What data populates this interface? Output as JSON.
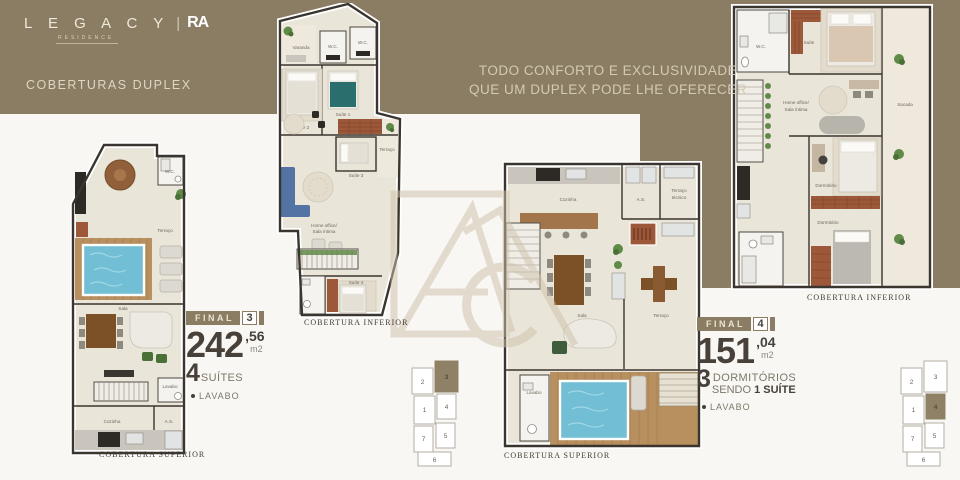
{
  "colors": {
    "brand_gold": "#8a7d64",
    "cream_text": "#ddd5c0",
    "dark_text": "#474139",
    "muted_text": "#7d7769",
    "pool_blue": "#72bfd5",
    "deck_wood": "#b8905f",
    "caption_text": "#423c32"
  },
  "header": {
    "logo_name": "L E G A C Y",
    "logo_divider": "|",
    "logo_partner": "RA",
    "logo_sub": "RESIDENCE",
    "subtitle": "COBERTURAS DUPLEX",
    "tagline_1": "TODO CONFORTO E EXCLUSIVIDADE",
    "tagline_2": "QUE UM DUPLEX PODE LHE OFERECER"
  },
  "unit3": {
    "badge_label": "FINAL",
    "badge_number": "3",
    "area_int": "242",
    "area_dec": ",56",
    "area_unit": "m2",
    "count": "4",
    "count_label": "SUÍTES",
    "bullet_item": "LAVABO"
  },
  "unit4": {
    "badge_label": "FINAL",
    "badge_number": "4",
    "area_int": "151",
    "area_dec": ",04",
    "area_unit": "m2",
    "count": "3",
    "count_label": "DORMITÓRIOS",
    "sub_prefix": "SENDO ",
    "sub_bold": "1 SUÍTE",
    "bullet_item": "LAVABO"
  },
  "plans": {
    "p1": {
      "caption": "COBERTURA SUPERIOR",
      "rooms": {
        "wc": "W.C.",
        "terraco": "Terraço",
        "sala": "Sala",
        "lavabo": "Lavabo",
        "cozinha": "Cozinha",
        "as": "A.S."
      }
    },
    "p2": {
      "caption": "COBERTURA INFERIOR",
      "rooms": {
        "varanda": "Varanda",
        "wc1": "W.C.",
        "wc2": "W.C.",
        "suite2": "Suíte 2",
        "suite1": "Suíte 1",
        "suite3": "Suíte 3",
        "terraco": "Terraço",
        "home1": "Home office/",
        "home2": "Sala íntima",
        "suite4": "Suíte 4"
      }
    },
    "p3": {
      "caption": "COBERTURA SUPERIOR",
      "rooms": {
        "cozinha": "Cozinha",
        "as": "A.S.",
        "ttec1": "Terraço",
        "ttec2": "técnico",
        "sala": "Sala",
        "terraco": "Terraço",
        "lavabo": "Lavabo"
      }
    },
    "p4": {
      "caption": "COBERTURA INFERIOR",
      "rooms": {
        "wc": "W.C.",
        "suite": "Suíte",
        "home1": "Home office/",
        "home2": "Sala íntima",
        "sacada": "Sacada",
        "dorm1": "Dormitório",
        "dorm2": "Dormitório"
      }
    }
  },
  "keyplans": {
    "left": {
      "highlight": "3",
      "cells": [
        "2",
        "3",
        "1",
        "4",
        "7",
        "5",
        "6"
      ]
    },
    "right": {
      "highlight": "4",
      "cells": [
        "2",
        "3",
        "1",
        "4",
        "7",
        "5",
        "6"
      ]
    }
  }
}
